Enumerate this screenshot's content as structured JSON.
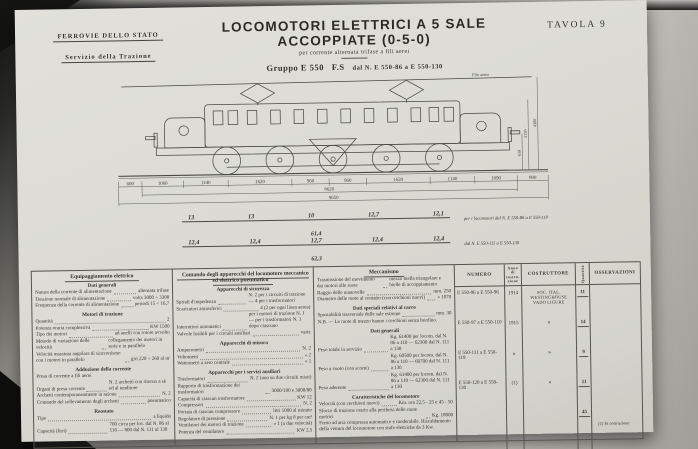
{
  "colors": {
    "paper": "#dcdbd5",
    "ink": "#33322e",
    "background_dark": "#141412"
  },
  "header": {
    "org_line1": "FERROVIE DELLO STATO",
    "org_line2": "Servizio della Trazione",
    "title": "LOCOMOTORI ELETTRICI A 5 SALE ACCOPPIATE (0-5-0)",
    "subtitle": "per corrente alternata trifase a fili aerei",
    "group_name": "Gruppo E 550",
    "group_fs": "F.S",
    "group_range": "dal N. E 550-86 a E 550-130",
    "plate": "TAVOLA 9"
  },
  "drawing": {
    "wire_label": "Filo aereo",
    "dim_chain": [
      "600",
      "1060",
      "1140",
      "1620",
      "960",
      "960",
      "1620",
      "1140",
      "1090",
      "800"
    ],
    "dim_total_upper": "8620",
    "dim_total_lower": "9650",
    "dim_height_body": "3150",
    "dim_height_pantograph": "4300",
    "dim_buffer_height": "630",
    "axle_loads": [
      {
        "values": [
          "13",
          "13",
          "10",
          "12,7",
          "12,1"
        ],
        "total": "61,4",
        "note": "per i locomotori dal N. E 550-86 a E 550-110"
      },
      {
        "values": [
          "12,4",
          "12,4",
          "12,7",
          "12,4",
          "12,4"
        ],
        "total": "62,3",
        "note": "dal N. E 550-111 a E 550-130"
      }
    ]
  },
  "spec_table": {
    "columns": [
      {
        "header": "Equipaggiamento elettrico",
        "sections": [
          {
            "title": "Dati generali",
            "items": [
              {
                "l": "Natura della corrente di alimentazione",
                "v": "alternata trifase"
              },
              {
                "l": "Tensione normale di alimentazione",
                "v": "volts 3000 ÷ 3300"
              },
              {
                "l": "Frequenza della corrente di alimentazione",
                "v": "periodi 15 ÷ 16,7"
              }
            ]
          },
          {
            "title": "Motori di trazione",
            "items": [
              {
                "l": "Quantità",
                "v": "2"
              },
              {
                "l": "Potenza oraria complessiva",
                "v": "KW 1500"
              },
              {
                "l": "Tipo dei motori",
                "v": "ad anelli con rotore avvolto"
              },
              {
                "l": "Metodo di variazione delle velocità",
                "v": "collegamento dei motori in serie e in parallelo"
              },
              {
                "l": "Velocità massima angolare di sincronismo con i motori in parallelo",
                "v": "giri 220 ÷ 260 al m'"
              }
            ]
          },
          {
            "title": "Adduzione della corrente",
            "items": [
              {
                "l": "Presa di corrente a fili aerei",
                "v": ""
              },
              {
                "l": "Organi di presa corrente",
                "v": "N. 2 archetti con ritorno a sè ed al tenditore"
              },
              {
                "l": "Archetti contemporaneamente in azione",
                "v": "N. 2"
              },
              {
                "l": "Comando del sollevamento degli archetti",
                "v": "pneumatico"
              }
            ]
          },
          {
            "title": "Reostato",
            "items": [
              {
                "l": "Tipo",
                "v": "a liquido"
              },
              {
                "l": "Capacità (litri)",
                "v": "700 circa per loc. dal N. 86 al 110 — 800 dal N. 111 al 130"
              }
            ]
          }
        ]
      },
      {
        "header": "Comando degli apparecchi del locomotore meccanico ed elettrico pneumatico",
        "sections": [
          {
            "title": "Apparecchi di sicurezza",
            "items": [
              {
                "l": "Spirali d'impedenza",
                "v": "N. 2 per i circuiti di trazione — 4 per i trasformatori"
              },
              {
                "l": "Scaricatori atmosferici",
                "v": "4 (2 per ogni linea aerea)"
              },
              {
                "l": "Interruttori automatici",
                "v": "per i motori di trazione N. 1 — per i trasformatori N. 1 dopo ciascuno"
              },
              {
                "l": "Valvole fusibili per i circuiti ausiliari",
                "v": "varie"
              }
            ]
          },
          {
            "title": "Apparecchi di misura",
            "items": [
              {
                "l": "Amperometri",
                "v": "N. 2"
              },
              {
                "l": "Voltometri",
                "v": "» 2"
              },
              {
                "l": "Wattometri a zero centrale",
                "v": "» 1"
              }
            ]
          },
          {
            "title": "Apparecchi per i servizi ausiliari",
            "items": [
              {
                "l": "Trasformatori",
                "v": "N. 2 (uno su due circuiti misti)"
              },
              {
                "l": "Rapporto di trasformazione dei trasformatori",
                "v": "3000/100 e 3000/80"
              },
              {
                "l": "Capacità di ciascun trasformatore",
                "v": "KW 12"
              },
              {
                "l": "Compressori",
                "v": "N. 2"
              },
              {
                "l": "Portata di ciascun compressore",
                "v": "litri 1000 al minuto"
              },
              {
                "l": "Regolatore di pressione",
                "v": "N. 1 per kg 8 per cm²"
              },
              {
                "l": "Ventilatori dei motori di trazione",
                "v": "» 1 (a due velocità)"
              },
              {
                "l": "Potenza del ventilatore",
                "v": "KW 2,5"
              }
            ]
          }
        ]
      },
      {
        "header": "Meccanismo",
        "sections": [
          {
            "title": "",
            "items": [
              {
                "l": "Trasmissione del movimento dai motori alle ruote",
                "v": "mezzo biella triangolare e bielle di accoppiamento"
              },
              {
                "l": "Raggio delle manovelle",
                "v": "mm. 250"
              },
              {
                "l": "Diametro delle ruote al contatto (con cerchioni nuovi)",
                "v": "» 1070"
              }
            ]
          },
          {
            "title": "Dati speciali relativi al carro",
            "items": [
              {
                "l": "Spostabilità trasversale delle sale estreme",
                "v": "mm. 30"
              },
              {
                "l": "N.B. — Le ruote di mezzo hanno i cerchioni senza bordino.",
                "v": ""
              }
            ]
          },
          {
            "title": "Dati generali",
            "items": [
              {
                "l": "Peso totale in servizio",
                "v": "Kg. 61400 per locom. dal N. 86 a 110 — 62300 dal N. 111 a 130"
              },
              {
                "l": "Peso a vuoto (con scorte)",
                "v": "Kg. 60500 per locom. dal N. 86 a 110 — 60700 dal N. 111 a 130"
              },
              {
                "l": "Peso aderente",
                "v": "Kg. 61400 per locom. dal N. 86 a 110 — 62300 dal N. 111 a 130"
              }
            ]
          },
          {
            "title": "Caratteristiche del locomotore",
            "items": [
              {
                "l": "Velocità (con cerchioni nuovi)",
                "v": "Km. ora 22,5 - 25 e 45 - 50"
              },
              {
                "l": "Sforzo di trazione orario alla periferia delle ruote motrici",
                "v": "Kg. 18000"
              },
              {
                "l": "Freno ad aria compressa automatico e moderabile. Riscaldamento della vettura del locomotore con stufe elettriche da 3 Kw.",
                "v": ""
              }
            ]
          }
        ]
      }
    ],
    "registry": {
      "headers": {
        "numero": "NUMERO",
        "anno": "Anno di costru- zione",
        "costruttore": "COSTRUTTORE",
        "quantita": "Quantità",
        "osservazioni": "OSSERVAZIONI"
      },
      "rows": [
        {
          "numero": "E 550-86 a E 550-96",
          "anno": "1914",
          "costruttore": "Soc. Ital. Westinghouse Vado Ligure",
          "quantita": "11"
        },
        {
          "numero": "E 550-97 a E 550-110",
          "anno": "1915",
          "costruttore": "»",
          "quantita": "14"
        },
        {
          "numero": "E 550-111 a E 550-119",
          "anno": "»",
          "costruttore": "»",
          "quantita": "9"
        },
        {
          "numero": "E 550-120 a E 550-130",
          "anno": "(1)",
          "costruttore": "»",
          "quantita": "11"
        }
      ],
      "total": "45",
      "footnote": "(1) In costruzione"
    }
  }
}
